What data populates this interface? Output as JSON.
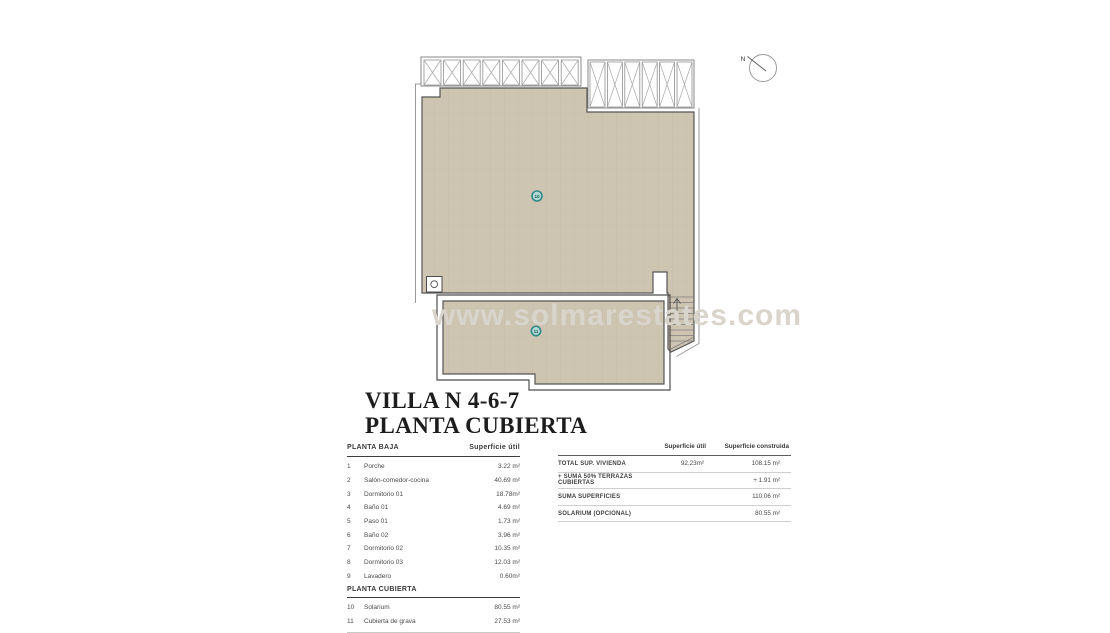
{
  "title": {
    "line1": "VILLA N 4-6-7",
    "line2": "PLANTA CUBIERTA"
  },
  "watermark": "www.solmarestates.com",
  "compass": {
    "label": "N"
  },
  "plan": {
    "markers": [
      {
        "id": "10"
      },
      {
        "id": "11"
      }
    ]
  },
  "left_table": {
    "section1": "PLANTA BAJA",
    "col": "Superficie útil",
    "rows": [
      {
        "num": "1",
        "label": "Porche",
        "value": "3.22 m²"
      },
      {
        "num": "2",
        "label": "Salón-comedor-cocina",
        "value": "40.69 m²"
      },
      {
        "num": "3",
        "label": "Dormitorio 01",
        "value": "18.78m²"
      },
      {
        "num": "4",
        "label": "Baño 01",
        "value": "4.69 m²"
      },
      {
        "num": "5",
        "label": "Paso 01",
        "value": "1.73 m²"
      },
      {
        "num": "6",
        "label": "Baño 02",
        "value": "3.96 m²"
      },
      {
        "num": "7",
        "label": "Dormitorio 02",
        "value": "10.35 m²"
      },
      {
        "num": "8",
        "label": "Dormitorio 03",
        "value": "12.03 m²"
      },
      {
        "num": "9",
        "label": "Lavadero",
        "value": "0.60m²"
      }
    ],
    "section2": "PLANTA CUBIERTA",
    "rows2": [
      {
        "num": "10",
        "label": "Solarium",
        "value": "80.55 m²"
      },
      {
        "num": "11",
        "label": "Cubierta de grava",
        "value": "27.53 m²"
      }
    ]
  },
  "right_table": {
    "col1": "Superficie útil",
    "col2": "Superficie construida",
    "rows": [
      {
        "label": "TOTAL SUP. VIVIENDA",
        "util": "92.23m²",
        "construida": "108.15 m²"
      },
      {
        "label": "+ SUMA 50% TERRAZAS CUBIERTAS",
        "util": "",
        "construida": "+ 1.91 m²"
      },
      {
        "label": "SUMA SUPERFICIES",
        "util": "",
        "construida": "110.06 m²"
      },
      {
        "label": "SOLARIUM (OPCIONAL)",
        "util": "",
        "construida": "80.55 m²"
      }
    ]
  },
  "colors": {
    "roof_fill": "#cec4b2",
    "outline": "#4d4d4d",
    "light_outline": "#9a9a9a",
    "marker_ring": "#2e8a8a",
    "marker_fill": "#b4d6d2",
    "watermark": "#d9d5cc"
  }
}
